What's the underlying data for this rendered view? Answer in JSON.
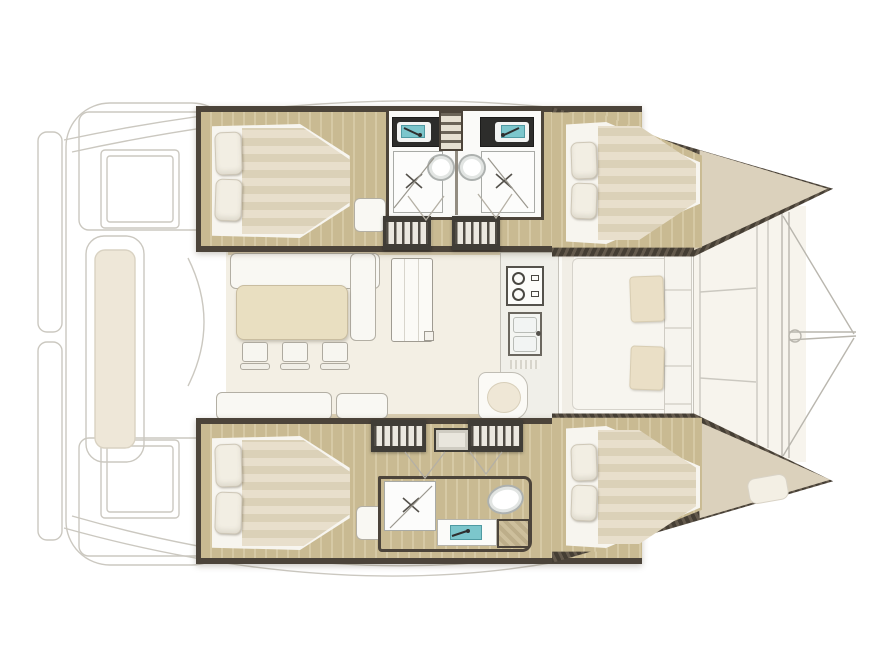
{
  "meta": {
    "diagram_type": "boat floor plan",
    "subject": "Catamaran interior layout, top-down view, bow to the right, 4 cabins and 3 heads",
    "visible_text": ""
  },
  "palette": {
    "background": "#ffffff",
    "hull_wall": "#4c443a",
    "wood_floor": "#c9ba92",
    "wood_floor_stripe": "#d6c9a5",
    "mattress": "#e8dfcc",
    "mattress_stripe": "#dbd1b8",
    "linen_white": "#f7f5ef",
    "bow_deck": "#dbd1bc",
    "saloon_floor": "#f3efe4",
    "table_beige": "#e9dfc1",
    "sink_teal": "#7cc6cc",
    "cushion_beige": "#eadfc6",
    "faded_outline": "#cbc8c0"
  },
  "areas": {
    "aft_cockpit": {
      "label": "Aft cockpit and transoms (faded outline)",
      "fixtures": [
        "port swim platform",
        "starboard swim platform",
        "aft-port cockpit table",
        "aft-starboard cockpit table",
        "transom bench with cushion",
        "sliding-door swing arc"
      ]
    },
    "port_hull": {
      "label": "Port hull (top)",
      "aft_cabin": {
        "label": "Port aft cabin",
        "fixtures": [
          "double berth",
          "pillow x2",
          "foot seat"
        ]
      },
      "heads": {
        "label": "Port heads, two back-to-back",
        "fixtures": [
          "vanity with teal sink x2",
          "toilet x2",
          "shower with drain x2",
          "central ladder"
        ]
      },
      "forward_cabin": {
        "label": "Port forward cabin",
        "fixtures": [
          "double berth",
          "pillow x2"
        ]
      },
      "stairs": {
        "label": "Companionway steps x2"
      }
    },
    "starboard_hull": {
      "label": "Starboard hull (bottom)",
      "aft_cabin": {
        "label": "Starboard aft cabin",
        "fixtures": [
          "double berth",
          "pillow x2",
          "foot seat"
        ]
      },
      "head": {
        "label": "Starboard head",
        "fixtures": [
          "shower with drain",
          "vanity with teal sink",
          "toilet",
          "wood cabinet"
        ]
      },
      "forward_cabin": {
        "label": "Starboard forward cabin",
        "fixtures": [
          "double berth",
          "pillow x2",
          "bow berth cushion"
        ]
      },
      "stairs": {
        "label": "Companionway steps x2 with entry step"
      }
    },
    "saloon": {
      "label": "Saloon",
      "fixtures": [
        "L-shaped settee",
        "dining table",
        "chair x3",
        "aft bench x2",
        "storage cabinet"
      ]
    },
    "galley": {
      "label": "Galley",
      "fixtures": [
        "two-burner stove",
        "double sink",
        "drying rack",
        "rounded peninsula"
      ]
    },
    "forward_cockpit": {
      "label": "Forward lounge (faded outline)",
      "fixtures": [
        "U-shaped seating",
        "cushion x2"
      ]
    },
    "foredeck": {
      "label": "Foredeck and rigging",
      "fixtures": [
        "deck seams",
        "forward crossbeam",
        "bowsprit",
        "forestay bridle"
      ]
    }
  }
}
